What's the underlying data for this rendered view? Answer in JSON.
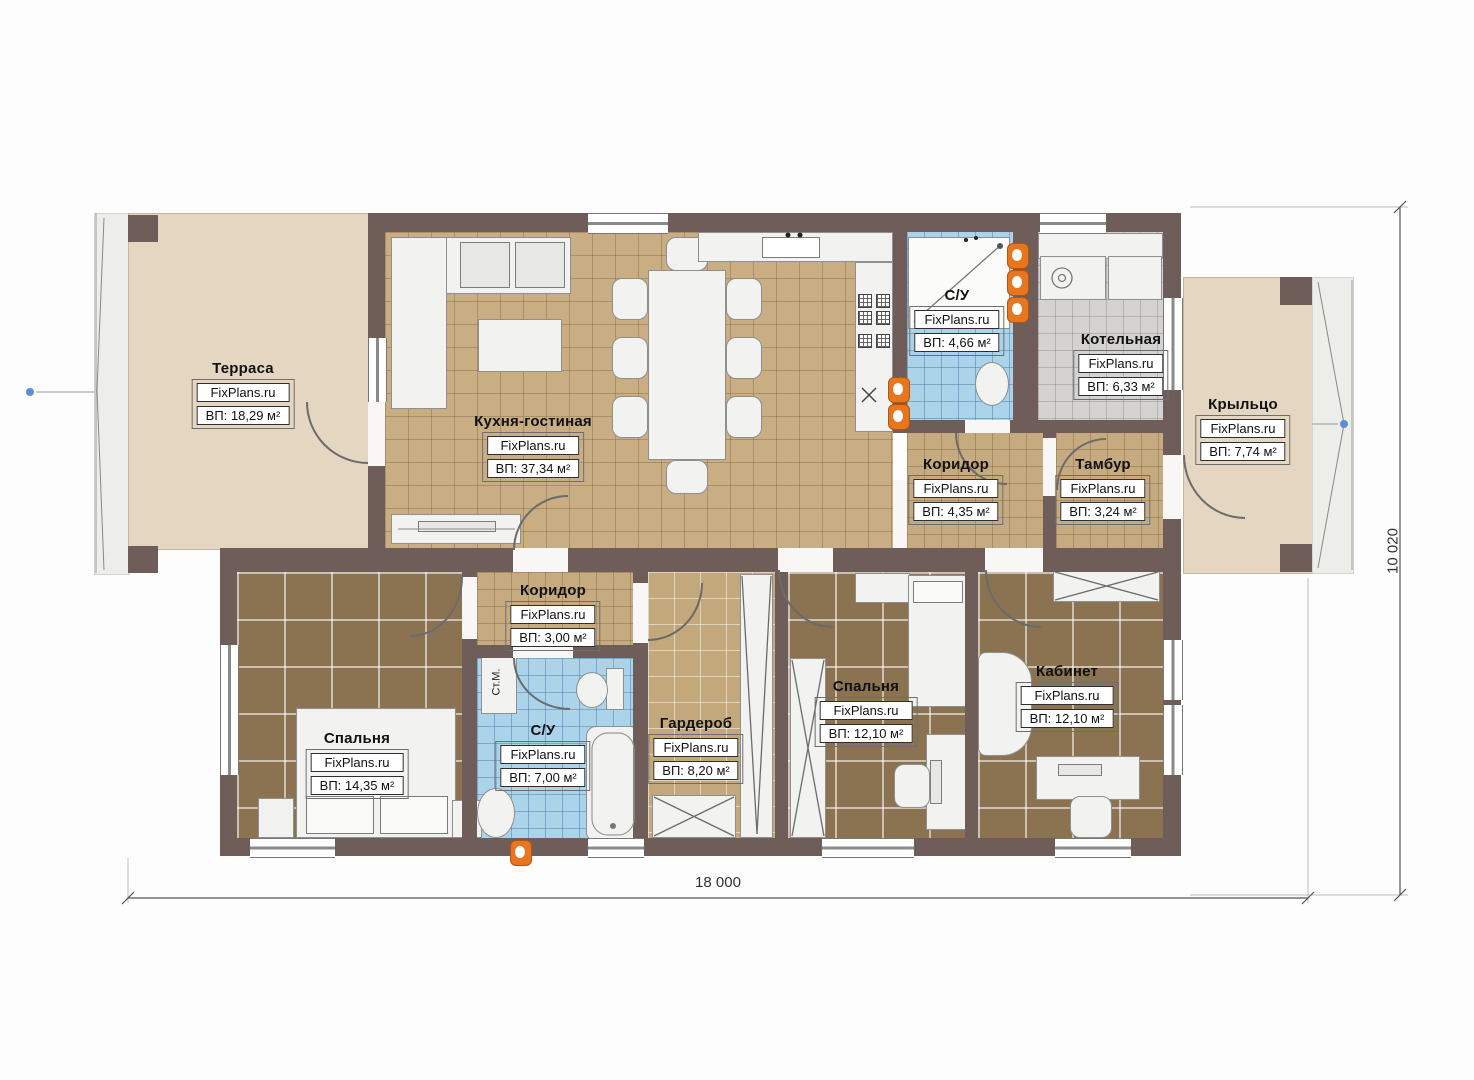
{
  "watermark": "FixPlans.ru",
  "rooms": {
    "terrace": {
      "name": "Терраса",
      "area": "ВП: 18,29 м²"
    },
    "kitchen_living": {
      "name": "Кухня-гостиная",
      "area": "ВП: 37,34 м²"
    },
    "bathroom_top": {
      "name": "С/У",
      "area": "ВП: 4,66 м²"
    },
    "boiler": {
      "name": "Котельная",
      "area": "ВП: 6,33 м²"
    },
    "porch": {
      "name": "Крыльцо",
      "area": "ВП: 7,74 м²"
    },
    "corridor_top": {
      "name": "Коридор",
      "area": "ВП: 4,35 м²"
    },
    "vestibule": {
      "name": "Тамбур",
      "area": "ВП: 3,24 м²"
    },
    "corridor_bottom": {
      "name": "Коридор",
      "area": "ВП: 3,00 м²"
    },
    "bedroom_left": {
      "name": "Спальня",
      "area": "ВП: 14,35 м²"
    },
    "bathroom_bottom": {
      "name": "С/У",
      "area": "ВП: 7,00 м²"
    },
    "wardrobe": {
      "name": "Гардероб",
      "area": "ВП: 8,20 м²"
    },
    "bedroom_middle": {
      "name": "Спальня",
      "area": "ВП: 12,10 м²"
    },
    "office": {
      "name": "Кабинет",
      "area": "ВП: 12,10 м²"
    }
  },
  "labels": {
    "washing_machine": "Ст.М."
  },
  "dimensions": {
    "width": "18 000",
    "height": "10 020"
  },
  "colors": {
    "wall": "#6f5d5a",
    "floor_tan": "#c9ad83",
    "floor_dark": "#8b7352",
    "tile_blue": "#abd3ea",
    "tile_gray": "#d4d3d1",
    "beige": "#e4d6c1",
    "radiator_orange": "#e8761e",
    "axis_marker_blue": "#5b8fd4"
  }
}
